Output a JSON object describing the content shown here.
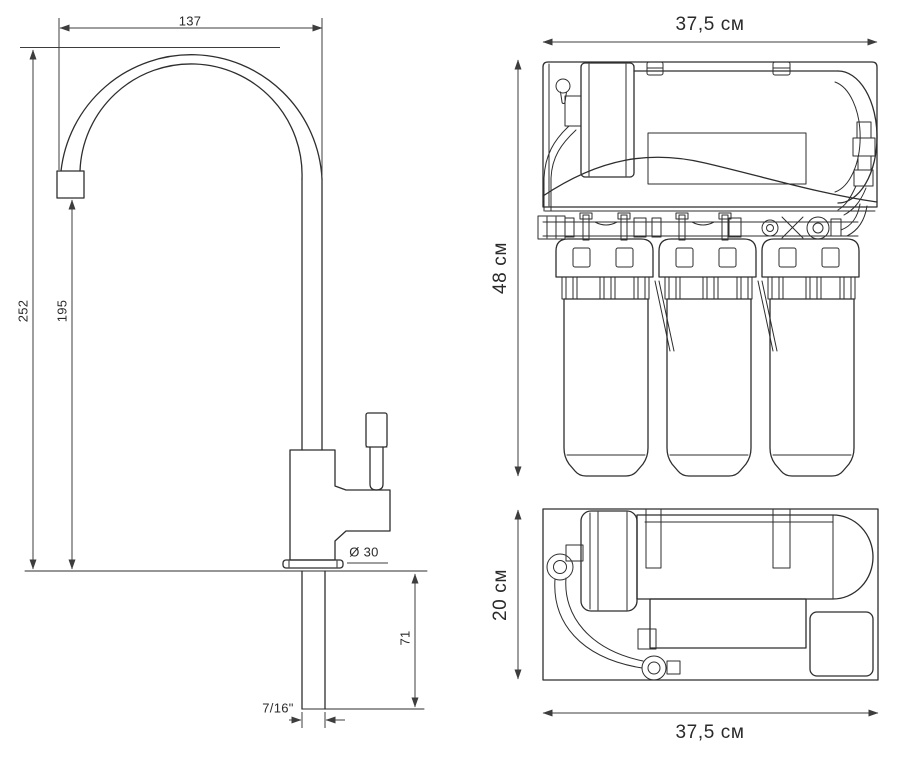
{
  "colors": {
    "background": "#ffffff",
    "drawing_line": "#2e2e2e",
    "dimension_line": "#3d3d3d",
    "text": "#2a2a2a"
  },
  "faucet": {
    "dimensions": {
      "spout_width": "137",
      "total_height": "252",
      "spout_height": "195",
      "base_diameter": "Ø 30",
      "under_counter_height": "71",
      "thread": "7/16\""
    }
  },
  "filter_front_view": {
    "width": "37,5 см",
    "height": "48 см"
  },
  "filter_top_view": {
    "depth": "20 см",
    "width": "37,5 см"
  }
}
